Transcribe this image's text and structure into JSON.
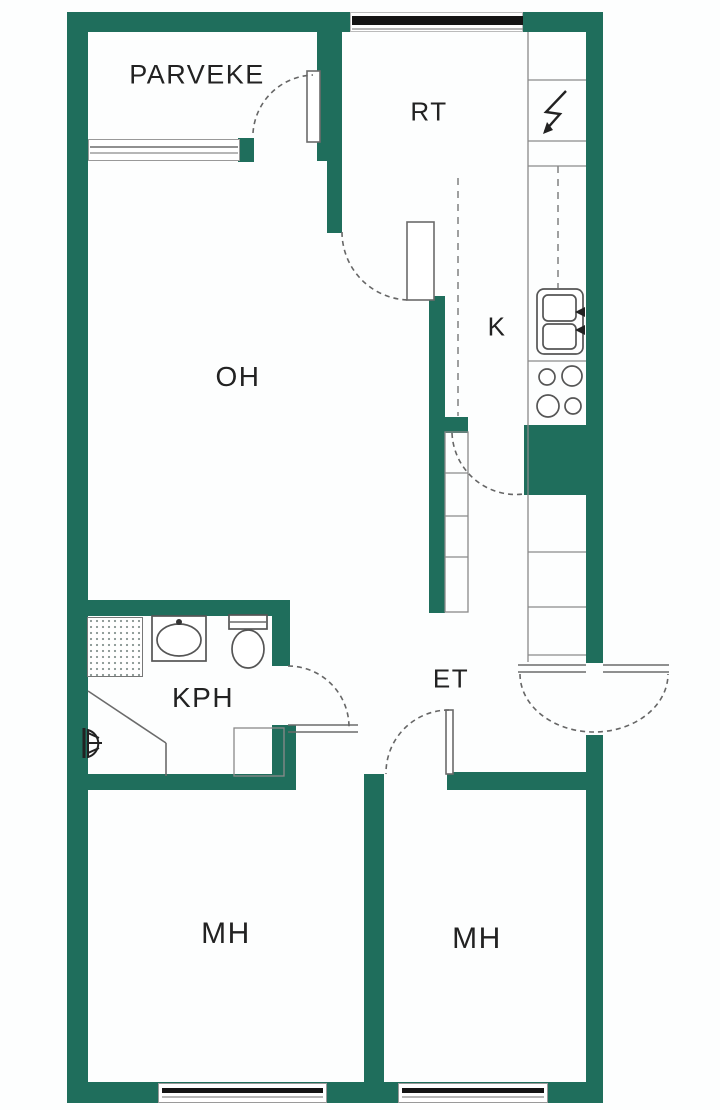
{
  "title": "apartment-floor-plan",
  "colors": {
    "wall": "#1f6e5c",
    "line": "#6b6b6b",
    "text": "#222222",
    "window_dark": "#141414"
  },
  "rooms": {
    "parveke": {
      "label": "PARVEKE"
    },
    "rt": {
      "label": "RT"
    },
    "oh": {
      "label": "OH"
    },
    "k": {
      "label": "K"
    },
    "kph": {
      "label": "KPH"
    },
    "et": {
      "label": "ET"
    },
    "mh_left": {
      "label": "MH"
    },
    "mh_right": {
      "label": "MH"
    }
  },
  "fixtures": [
    "balcony-window",
    "balcony-door",
    "rt-window",
    "electrical-cabinet-lightning",
    "kitchen-sink",
    "kitchen-stove",
    "kitchen-duct-block",
    "tall-cabinet-column",
    "shower-area",
    "washbasin",
    "toilet",
    "floor-drain-vent",
    "entry-door",
    "bathroom-door",
    "bedroom-door",
    "bedroom-window-left",
    "bedroom-window-right"
  ]
}
